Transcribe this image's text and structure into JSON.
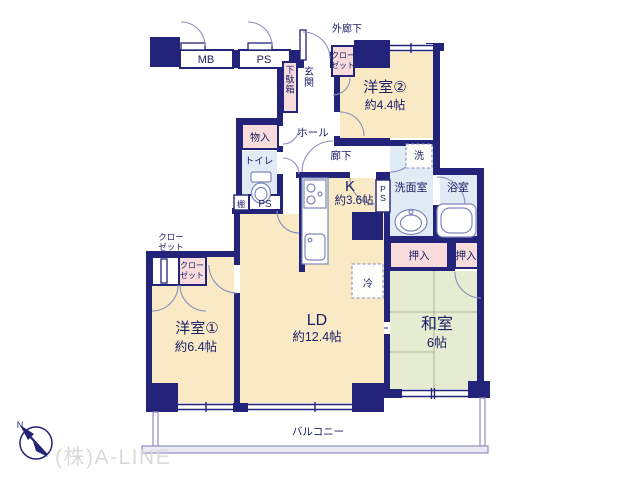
{
  "floorplan": {
    "rooms": {
      "yoshitsu2": {
        "name": "洋室②",
        "size": "約4.4帖"
      },
      "yoshitsu1": {
        "name": "洋室①",
        "size": "約6.4帖"
      },
      "ld": {
        "name": "LD",
        "size": "約12.4帖"
      },
      "kitchen": {
        "name": "K",
        "size": "約3.6帖"
      },
      "washitsu": {
        "name": "和室",
        "size": "6帖"
      },
      "senmenshitsu": "洗面室",
      "yokushitsu": "浴室",
      "toilet": "トイレ",
      "genkan": "玄関",
      "hall": "ホール",
      "roka": "廊下",
      "gairoka": "外廊下",
      "balcony": "バルコニー"
    },
    "storage": {
      "mb": "MB",
      "ps": "PS",
      "tana": "棚",
      "getabako": "下駄箱",
      "monoire": "物入",
      "oshiire": "押入",
      "closet_line1": "クロー",
      "closet_line2": "ゼット",
      "refrigerator": "冷",
      "washer": "洗"
    },
    "compass": {
      "north": "N"
    },
    "watermark": "(株)A-LINE",
    "colors": {
      "wall": "#232379",
      "room_cream": "#F9E9C5",
      "tatami_green": "#E6ECD1",
      "wet_blue": "#E1EBF5",
      "closet_pink": "#F8DCDC",
      "line_blue": "#8A90BE",
      "text_navy": "#1C2168",
      "balcony_line": "#8F8FBF",
      "watermark_gray": "#D9D9D9"
    }
  }
}
